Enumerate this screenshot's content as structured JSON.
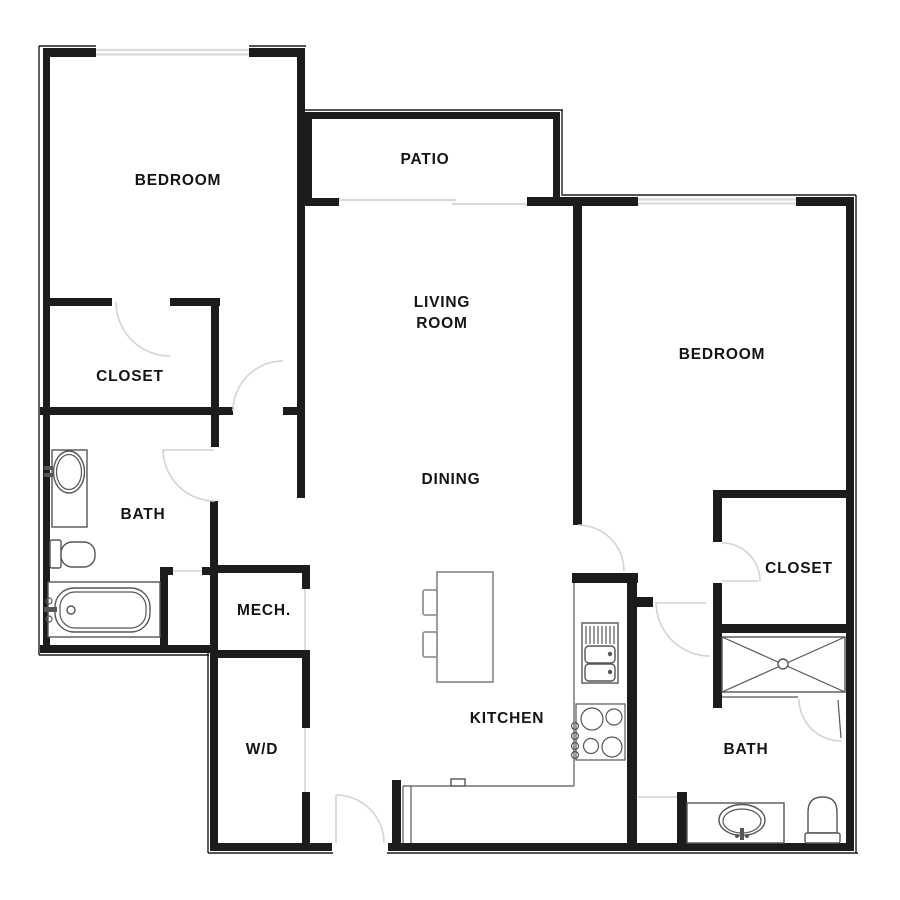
{
  "labels": {
    "bedroom_left": "BEDROOM",
    "closet_left": "CLOSET",
    "bath_left": "BATH",
    "mech": "MECH.",
    "laundry": "W/D",
    "patio": "PATIO",
    "living_room_line1": "LIVING",
    "living_room_line2": "ROOM",
    "dining": "DINING",
    "kitchen": "KITCHEN",
    "bedroom_right": "BEDROOM",
    "closet_right": "CLOSET",
    "bath_right": "BATH"
  },
  "colors": {
    "wall": "#1c1c1c",
    "window": "#d9d9d9",
    "opening": "#d3d3d3",
    "fixture": "#565656",
    "furniture": "#949494",
    "background": "#ffffff",
    "label": "#141414"
  }
}
